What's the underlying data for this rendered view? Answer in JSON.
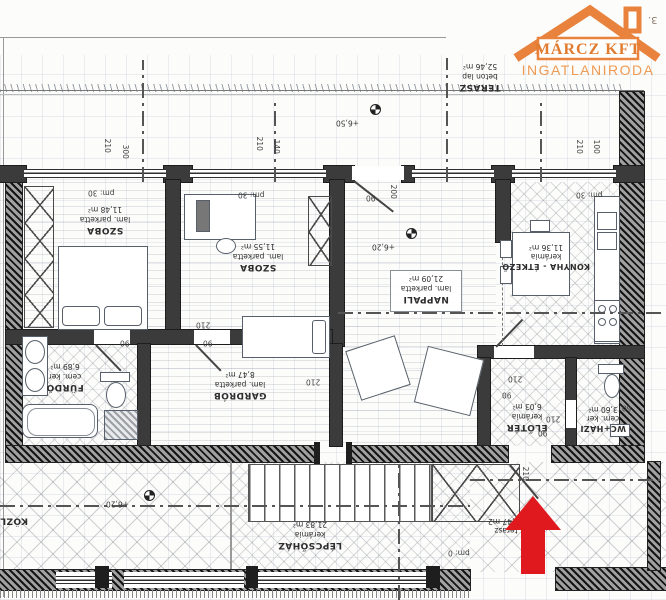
{
  "logo": {
    "title": "MÁRCZ KFT",
    "subtitle": "INGATLANIRODA"
  },
  "page_number": "3.",
  "rooms": {
    "szoba1": {
      "name": "SZOBA",
      "floor": "lam. parketta",
      "area": "11,48 m²"
    },
    "szoba2": {
      "name": "SZOBA",
      "floor": "lam. parketta",
      "area": "11,55 m²"
    },
    "nappali": {
      "name": "NAPPALI",
      "floor": "lam. parketta",
      "area": "21,09 m²"
    },
    "konyha": {
      "name": "KONYHA - ÉTKEZŐ",
      "floor": "kerámia",
      "area": "11,36 m²"
    },
    "furdo": {
      "name": "FÜRDŐ",
      "floor": "cem. ker",
      "area": "6,89 m²"
    },
    "gardrob": {
      "name": "GARDRÓB",
      "floor": "lam. parketta",
      "area": "8,47 m²"
    },
    "eloter": {
      "name": "ELŐTÉR",
      "floor": "kerámia",
      "area": "6,03 m²"
    },
    "wc": {
      "name": "WC+HÁZI",
      "floor": "cem. ker",
      "area": "3,60 m²"
    },
    "lepcsohaz": {
      "name": "LÉPCSŐHÁZ",
      "floor": "kerámia",
      "area": "21,83 m²"
    },
    "terasz": {
      "name": "TERASZ",
      "floor": "beton lap",
      "area": "52,46 m²"
    },
    "kozl": {
      "name": "KÖZL"
    },
    "terasz_also": {
      "name": "terasz",
      "area": "52,47 m2"
    }
  },
  "levels": {
    "terasz": "+6,50",
    "nappali": "+6,20",
    "kozl": "+6,20"
  },
  "dims": [
    "210",
    "300",
    "210",
    "140",
    "210",
    "100",
    "200",
    "210",
    "90",
    "210",
    "90",
    "90",
    "210",
    "210",
    "90",
    "210",
    "90",
    "60",
    "pm: 30",
    "pm: 30",
    "pm: 30",
    "pm: 0"
  ],
  "colors": {
    "logo_orange": "#e8823c",
    "arrow_red": "#e0191f"
  }
}
